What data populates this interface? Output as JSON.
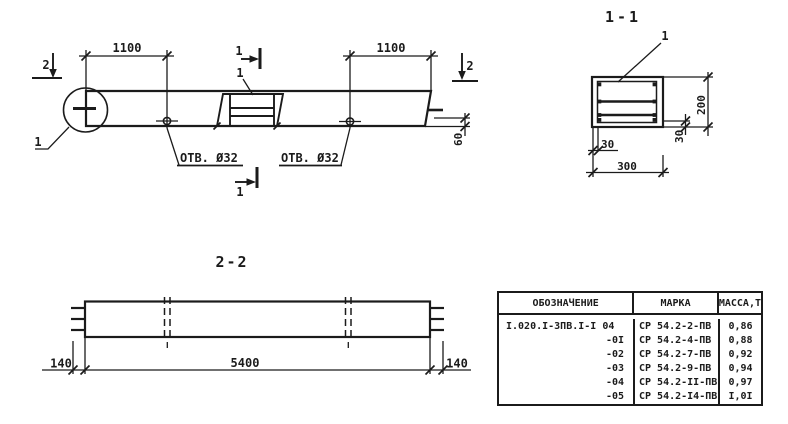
{
  "colors": {
    "ink": "#1b1b1b",
    "paper": "#ffffff"
  },
  "elevation": {
    "dim_left": "1100",
    "dim_right": "1100",
    "dim_end": "60",
    "hole_label_left": "ОТВ. Ø32",
    "hole_label_right": "ОТВ. Ø32",
    "detail_callout": "1",
    "opening_callout": "1",
    "section_mark_1": "1",
    "section_mark_2": "2"
  },
  "section_1_1": {
    "title": "1-1",
    "rebar_callout": "1",
    "dim_height": "200",
    "dim_width": "300",
    "dim_cover_side": "30",
    "dim_cover_bottom": "30"
  },
  "section_2_2": {
    "title": "2-2",
    "dim_left": "140",
    "dim_length": "5400",
    "dim_right": "140"
  },
  "table": {
    "headers": [
      "ОБОЗНАЧЕНИЕ",
      "МАРКА",
      "МАССА,Т"
    ],
    "rows": [
      {
        "designation": "I.020.I-3ПВ.I-I 04",
        "mark": "СР 54.2-2-ПВ",
        "mass": "0,86"
      },
      {
        "designation": "-0I",
        "mark": "СР 54.2-4-ПВ",
        "mass": "0,88"
      },
      {
        "designation": "-02",
        "mark": "СР 54.2-7-ПВ",
        "mass": "0,92"
      },
      {
        "designation": "-03",
        "mark": "СР 54.2-9-ПВ",
        "mass": "0,94"
      },
      {
        "designation": "-04",
        "mark": "СР 54.2-II-ПВ",
        "mass": "0,97"
      },
      {
        "designation": "-05",
        "mark": "СР 54.2-I4-ПВ",
        "mass": "I,0I"
      }
    ]
  }
}
